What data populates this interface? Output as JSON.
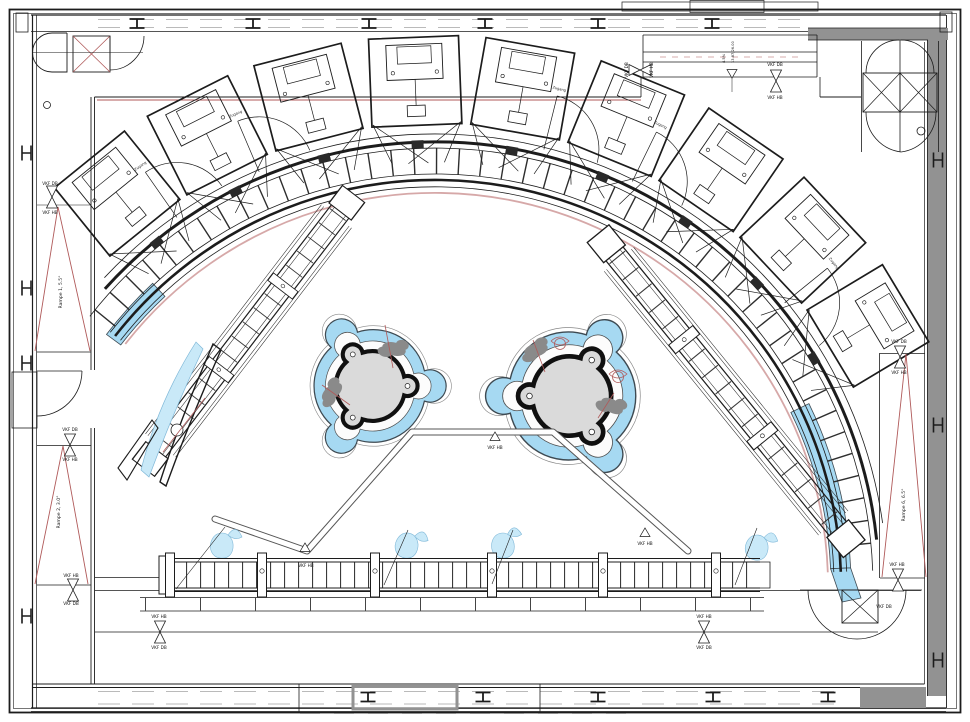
{
  "colors": {
    "line": "#1c1c1c",
    "accent_red": "#b05a5a",
    "arc_pink": "#d6a8a8",
    "water_blue": "#a6d9f2",
    "water_light": "#c9e9f8",
    "wall_gray": "#929292",
    "pool_gray": "#dadada",
    "bush_gray": "#8a8a8a",
    "paper": "#ffffff"
  },
  "labels": {
    "vkf_db": "VKF DB",
    "vkf_hb": "VKF HB",
    "zugang": "Zugang",
    "slope": "4.5%",
    "dimension": "13.87/26.00",
    "ramp_1": "Rampe 1, 5.5°",
    "ramp_2": "Rampe 2, 3.0°",
    "ramp_6": "Rampe 6, 6.5°"
  }
}
